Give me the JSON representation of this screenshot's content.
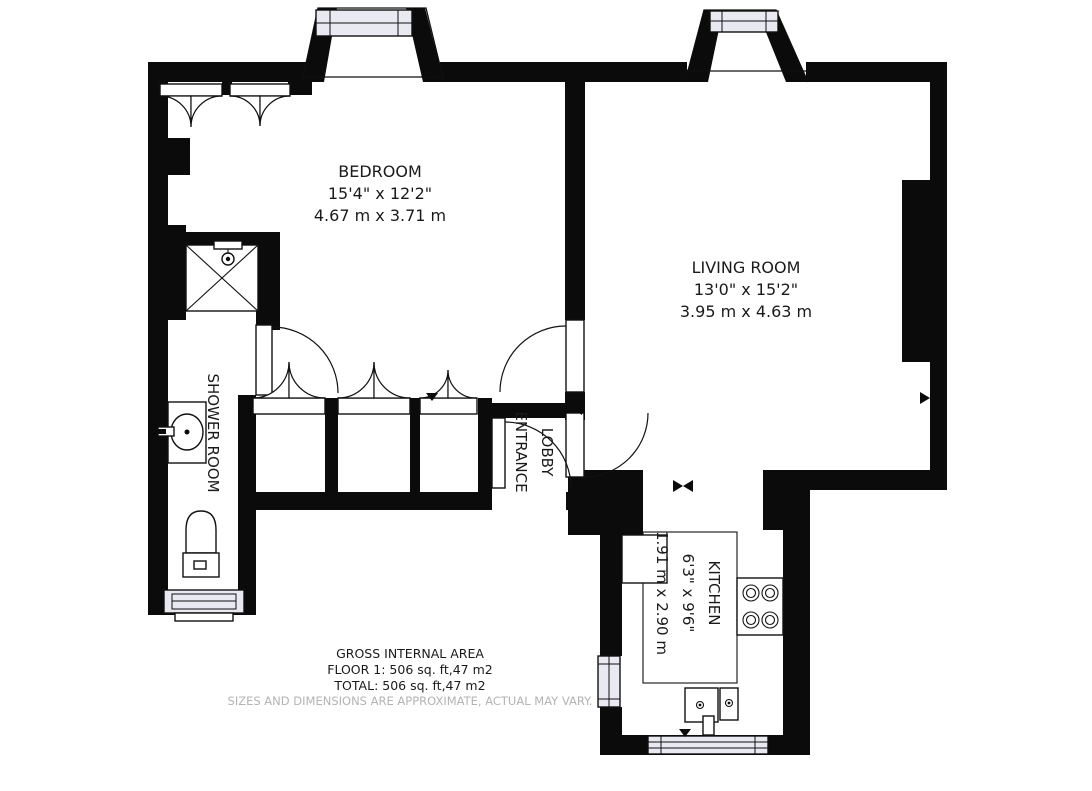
{
  "plan": {
    "bedroom": {
      "name": "BEDROOM",
      "imperial": "15'4\" x 12'2\"",
      "metric": "4.67 m x 3.71 m"
    },
    "living_room": {
      "name": "LIVING ROOM",
      "imperial": "13'0\" x 15'2\"",
      "metric": "3.95 m x 4.63 m"
    },
    "kitchen": {
      "name": "KITCHEN",
      "imperial": "6'3\" x 9'6\"",
      "metric": "1.91 m x 2.90 m"
    },
    "shower_room": {
      "name": "SHOWER ROOM"
    },
    "entrance_lobby": {
      "line1": "ENTRANCE",
      "line2": "LOBBY"
    },
    "summary": {
      "title": "GROSS INTERNAL AREA",
      "floor": "FLOOR 1: 506 sq. ft,47 m2",
      "total": "TOTAL: 506 sq. ft,47 m2",
      "disclaimer": "SIZES AND DIMENSIONS ARE APPROXIMATE, ACTUAL MAY VARY."
    },
    "colors": {
      "wall": "#0b0b0b",
      "window_fill": "#e9e9f1",
      "text": "#1a1a1a",
      "muted": "#b3b3b3"
    }
  }
}
